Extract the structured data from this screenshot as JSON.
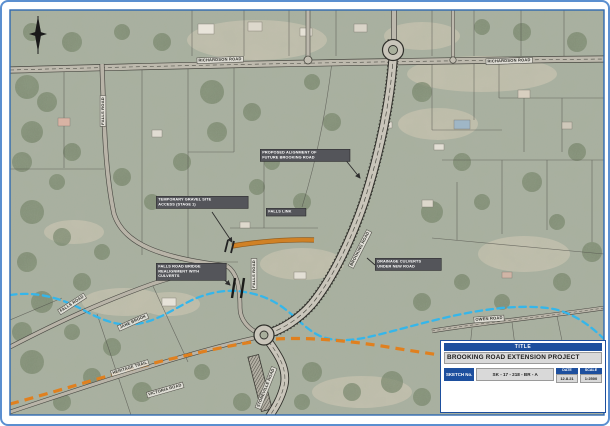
{
  "document": {
    "kind": "road-project-sketch-map"
  },
  "title_block": {
    "header": "TITLE",
    "project_title": "BROOKING ROAD EXTENSION PROJECT",
    "sketch_label": "SKETCH No.",
    "sketch_number": "SK - 17 - 218 - BR - A",
    "date_label": "DATE",
    "date_value": "12.8.21",
    "scale_label": "SCALE",
    "scale_value": "1:2500",
    "disclaimer": "Whilst all care has been taken in preparing this sketch, accuracy is not guaranteed. This sketch is a guide only."
  },
  "map": {
    "road_labels": [
      {
        "id": "richardson-road-west",
        "text": "RICHARDSON ROAD",
        "x": 218,
        "y": 58,
        "rot": -2
      },
      {
        "id": "richardson-road-east",
        "text": "RICHARDSON ROAD",
        "x": 507,
        "y": 59,
        "rot": -2
      },
      {
        "id": "falls-road-north",
        "text": "FALLS ROAD",
        "x": 101,
        "y": 109,
        "rot": -90
      },
      {
        "id": "brooking-road",
        "text": "BROOKING ROAD",
        "x": 358,
        "y": 247,
        "rot": -63
      },
      {
        "id": "falls-road-bridge",
        "text": "FALLS ROAD",
        "x": 252,
        "y": 272,
        "rot": -90
      },
      {
        "id": "falls-road-southwest",
        "text": "FALLS ROAD",
        "x": 70,
        "y": 302,
        "rot": -33
      },
      {
        "id": "jane-brook",
        "text": "JANE BROOK",
        "x": 131,
        "y": 320,
        "rot": -24
      },
      {
        "id": "owen-road",
        "text": "OWEN ROAD",
        "x": 487,
        "y": 317,
        "rot": -4
      },
      {
        "id": "heritage-trail",
        "text": "HERITAGE TRAIL",
        "x": 128,
        "y": 366,
        "rot": -17
      },
      {
        "id": "victoria-road",
        "text": "VICTORIA ROAD",
        "x": 163,
        "y": 388,
        "rot": -16
      },
      {
        "id": "stoneville-road",
        "text": "STONEVILLE ROAD",
        "x": 264,
        "y": 386,
        "rot": -68
      }
    ],
    "callouts": [
      {
        "id": "proposed-alignment-callout",
        "text": "PROPOSED ALIGNMENT OF\nFUTURE BROOKING ROAD",
        "x": 258,
        "y": 147,
        "w": 86
      },
      {
        "id": "temporary-gravel-access-callout",
        "text": "TEMPORARY GRAVEL SITE\nACCESS (STAGE 1)",
        "x": 154,
        "y": 194,
        "w": 88
      },
      {
        "id": "falls-link-callout",
        "text": "FALLS LINK",
        "x": 264,
        "y": 206,
        "w": 36
      },
      {
        "id": "falls-road-bridge-callout",
        "text": "FALLS ROAD BRIDGE\nREALIGNMENT WITH\nCULVERTS",
        "x": 154,
        "y": 261,
        "w": 66
      },
      {
        "id": "drainage-culverts-callout",
        "text": "DRAINAGE CULVERTS\nUNDER NEW ROAD",
        "x": 373,
        "y": 256,
        "w": 62
      }
    ],
    "features": {
      "creek_name": "JANE BROOK",
      "creek_style": "blue-dashed",
      "creek_color": "#35b6ea",
      "trail_name": "HERITAGE TRAIL",
      "trail_style": "orange-dashed",
      "trail_color": "#e0801f",
      "new_road_fill": "#c9c5ba",
      "falls_link_color": "#d08125",
      "north_arrow": "north-arrow"
    }
  },
  "colors": {
    "frame_blue": "#2f6ab0",
    "title_block_blue": "#1d4f9e",
    "aerial_base": "#a9afa0"
  }
}
